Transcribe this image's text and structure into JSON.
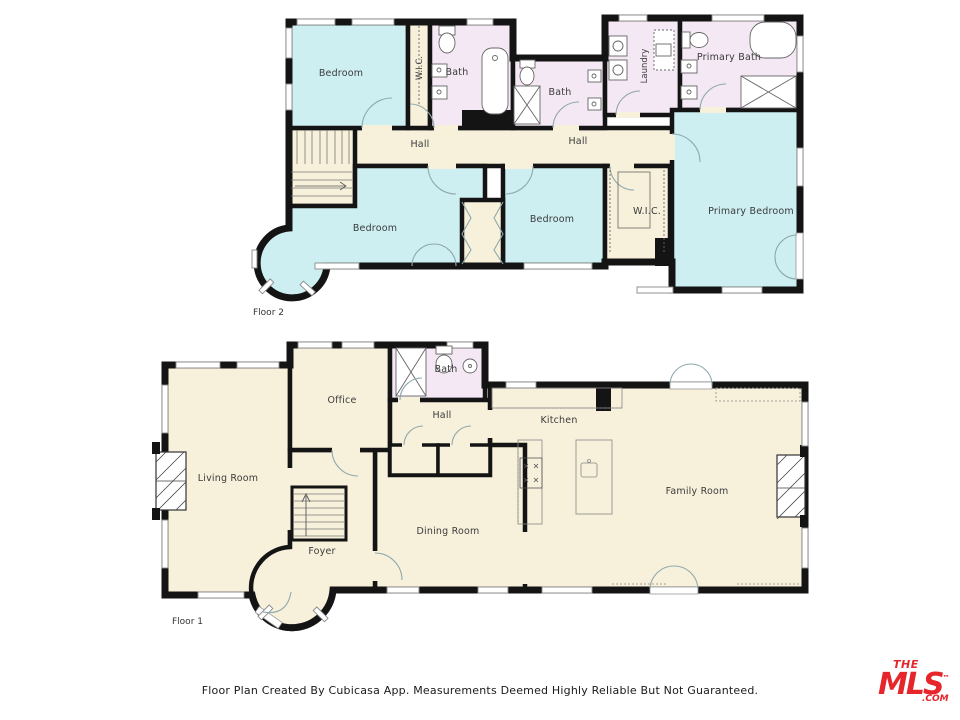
{
  "palette": {
    "wall": "#141414",
    "common": "#f7f1dc",
    "bedroom": "#cdeff2",
    "bath": "#f3e8f3",
    "door_arc": "#8fa8ad",
    "fixture": "#666666",
    "label": "#3b3b3b",
    "logo_red": "#e5262b"
  },
  "floor2": {
    "label": "Floor 2",
    "rooms": {
      "bedroom_tl": "Bedroom",
      "wic_left": "W.I.C.",
      "bath_front": "Bath",
      "bath_mid": "Bath",
      "laundry": "Laundry",
      "primary_bath": "Primary Bath",
      "hall_left": "Hall",
      "hall_right": "Hall",
      "bedroom_left": "Bedroom",
      "bedroom_mid": "Bedroom",
      "wic_right": "W.I.C.",
      "primary_bedroom": "Primary Bedroom"
    }
  },
  "floor1": {
    "label": "Floor 1",
    "rooms": {
      "living": "Living Room",
      "office": "Office",
      "bath": "Bath",
      "hall": "Hall",
      "kitchen": "Kitchen",
      "family": "Family Room",
      "dining": "Dining Room",
      "foyer": "Foyer"
    }
  },
  "footer": {
    "text": "Floor Plan Created By Cubicasa App. Measurements Deemed Highly Reliable But Not Guaranteed."
  },
  "logo": {
    "the": "THE",
    "mls": "MLS",
    "tm": "™",
    "com": ".COM"
  }
}
